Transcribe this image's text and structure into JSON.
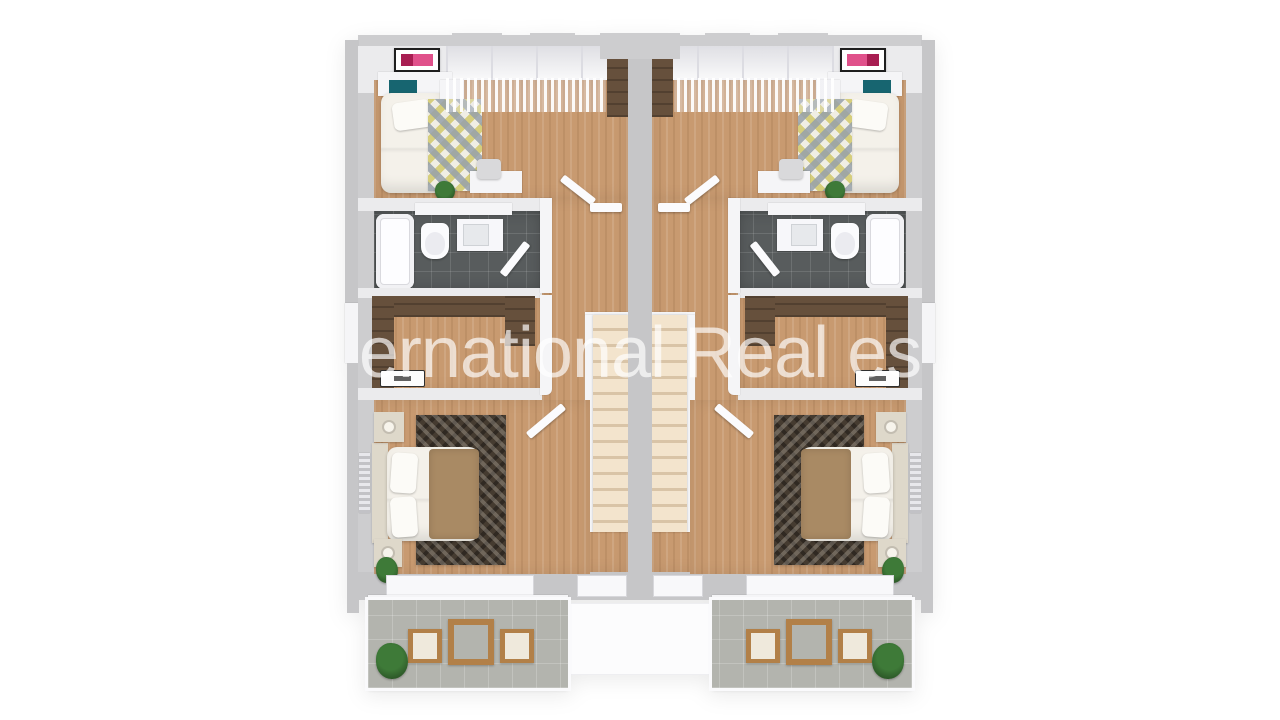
{
  "watermark": {
    "text": "ernational Real es",
    "color": "rgba(255,255,255,0.68)"
  },
  "scene": {
    "kind": "3D top-down floor plan render",
    "building": "semi-detached duplex upper floor, two mirrored units with central party wall and parallel staircases",
    "unit_rooms": [
      "bedroom",
      "bathroom",
      "walk-in closet",
      "master bedroom",
      "hallway with staircase",
      "balcony"
    ],
    "furniture": {
      "bedroom": [
        "single bed with teal headboard",
        "diamond pattern rug",
        "nightstand",
        "desk and chair",
        "framed pink wall art",
        "wardrobe",
        "plant"
      ],
      "bathroom": [
        "bathtub",
        "toilet",
        "washbasin vanity",
        "door"
      ],
      "walk_in_closet": [
        "wardrobe cabinets",
        "door mat"
      ],
      "master_bedroom": [
        "double bed with tan runner",
        "two nightstands with lamps",
        "dark patterned rug",
        "radiator",
        "plant"
      ],
      "balcony": [
        "square wooden table",
        "two wooden chairs",
        "potted plant",
        "white railing"
      ]
    }
  },
  "colors": {
    "wall_gray": "#c6c6c8",
    "wall_gray2": "#cdcdcf",
    "wall_face": "#ebebed",
    "wood": "#c89a70",
    "dark_wood": "#66503c",
    "tile_dark": "#585c5d",
    "balcony_tile": "#b3b4ae",
    "stair": "#f3e4cd",
    "stair_shadow": "#d9c4a7",
    "teal": "#176570",
    "art_pink": "#e0518b",
    "art_dark": "#a81e52",
    "rug_cream": "#f0eee4",
    "rug2_base": "#453b30",
    "duvet": "#f4f1ea",
    "blanket": "#a98a64",
    "cream": "#ded8ca",
    "plant": "#3e7a38",
    "plant_dark": "#2c5727",
    "furniture_wood": "#b28048",
    "seat": "#efe9dc",
    "rail": "#fafafc",
    "watermark": "rgba(255,255,255,0.68)"
  }
}
